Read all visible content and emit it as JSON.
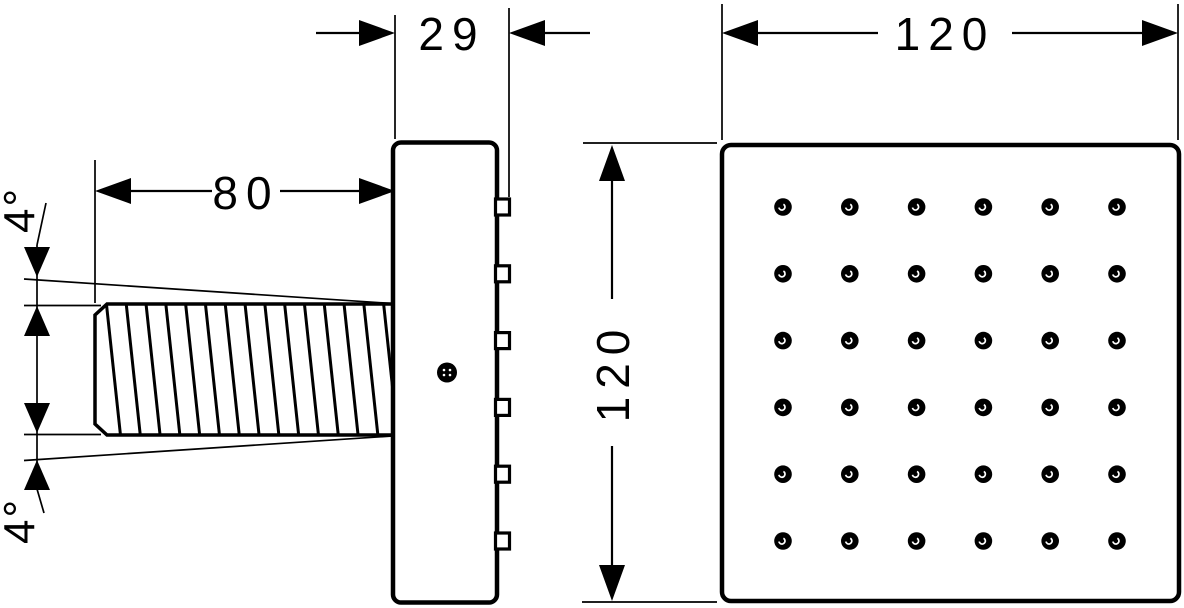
{
  "drawing": {
    "background_color": "#ffffff",
    "line_color": "#000000",
    "labels": {
      "dim_depth": "29",
      "dim_width": "120",
      "dim_height": "120",
      "dim_body_length": "80",
      "angle_top": "4°",
      "angle_bottom": "4°"
    },
    "side_view": {
      "hatch_line_count": 15,
      "nozzle_tab_count": 6,
      "screw_dot": "black"
    },
    "front_view": {
      "nozzle_rows": 6,
      "nozzle_cols": 6,
      "nozzle_color": "#000000"
    }
  }
}
